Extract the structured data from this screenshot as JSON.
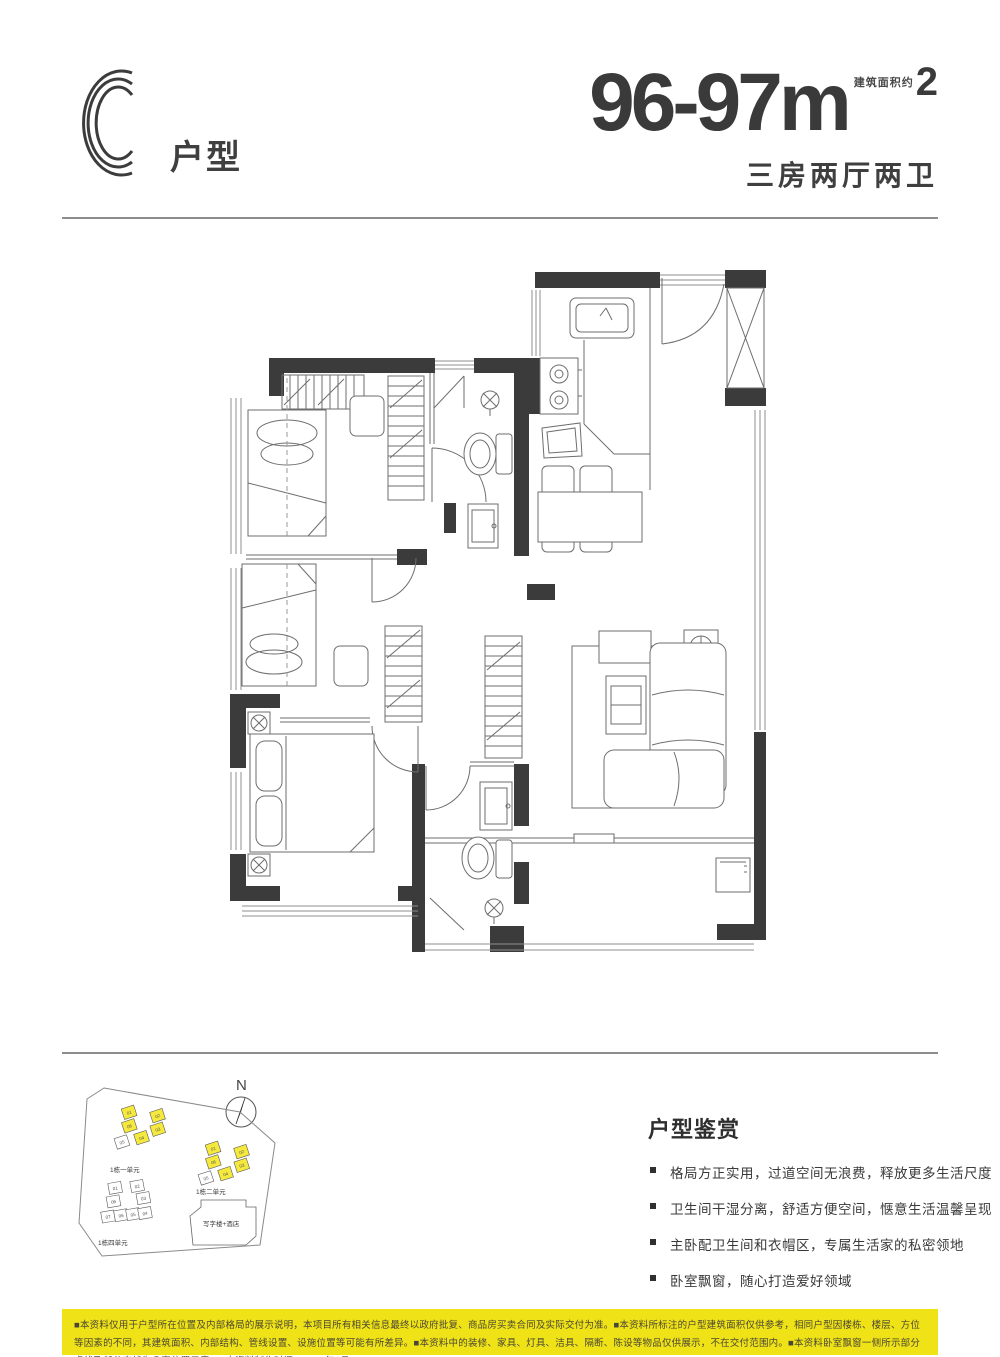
{
  "colors": {
    "wall_dark": "#3b3b3b",
    "accent_yellow_bar": "#efe216",
    "unit_highlight_yellow": "#f6e93e",
    "text_dark": "#3d3d3d"
  },
  "header": {
    "type_letter": "C",
    "type_label": "户型"
  },
  "spec": {
    "area_range": "96-97m",
    "area_note": "建筑面积约",
    "area_sup": "2",
    "layout_desc": "三房两厅两卫"
  },
  "site_plan": {
    "north_label": "N",
    "clusters": [
      {
        "label": "1栋一单元",
        "units": [
          "01",
          "06",
          "02",
          "03",
          "05",
          "04"
        ]
      },
      {
        "label": "1栋二单元",
        "units": [
          "01",
          "06",
          "02",
          "03",
          "05",
          "04"
        ]
      },
      {
        "label": "1栋四单元",
        "units": [
          "01",
          "02",
          "06",
          "03",
          "07",
          "06",
          "05",
          "04"
        ]
      }
    ],
    "office_label": "写字楼+酒店"
  },
  "appreciation": {
    "title": "户型鉴赏",
    "bullets": [
      "格局方正实用，过道空间无浪费，释放更多生活尺度",
      "卫生间干湿分离，舒适方便空间，惬意生活温馨呈现",
      "主卧配卫生间和衣帽区，专属生活家的私密领地",
      "卧室飘窗，随心打造爱好领域"
    ]
  },
  "disclaimer": {
    "text": "■本资料仅用于户型所在位置及内部格局的展示说明，本项目所有相关信息最终以政府批复、商品房买卖合同及实际交付为准。■本资料所标注的户型建筑面积仅供参考，相同户型因楼栋、楼层、方位等因素的不同，其建筑面积、内部结构、管线设置、设施位置等可能有所差异。■本资料中的装修、家具、灯具、洁具、隔断、陈设等物品仅供展示，不在交付范围内。■本资料卧室飘窗一侧所示部分虚线及部分实线为凸窗位置示意。■本资料制作时间：2022年6月。"
  }
}
